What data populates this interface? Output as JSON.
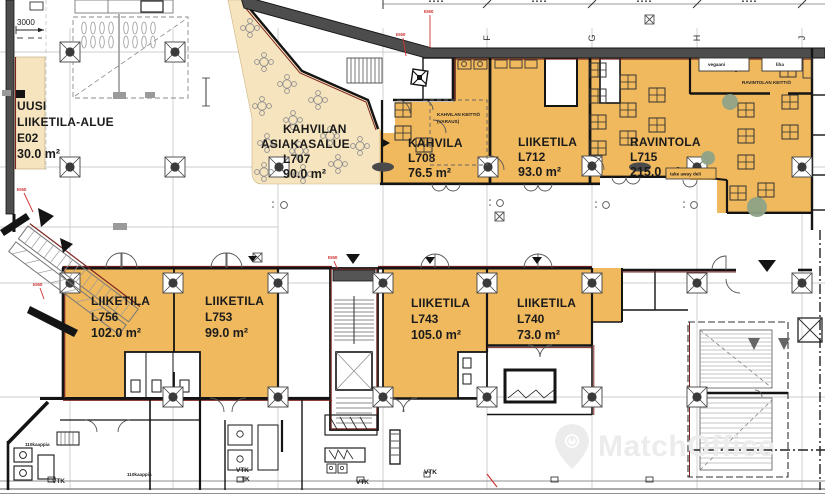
{
  "title": "Floor plan – commercial premises",
  "watermark": {
    "text": "MatchOffice"
  },
  "grid": {
    "letters": [
      "F",
      "G",
      "H",
      "J"
    ]
  },
  "dimensions": {
    "left_width": "3000"
  },
  "rooms": {
    "e02": {
      "l1": "UUSI",
      "l2": "LIIKETILA-ALUE",
      "id": "E02",
      "area": "30.0 m²"
    },
    "l707": {
      "l1": "KAHVILAN",
      "l2": "ASIAKASALUE",
      "id": "L707",
      "area": "90.0 m²"
    },
    "l708": {
      "name": "KAHVILA",
      "id": "L708",
      "area": "76.5 m²"
    },
    "l712": {
      "name": "LIIKETILA",
      "id": "L712",
      "area": "93.0 m²"
    },
    "l715": {
      "name": "RAVINTOLA",
      "id": "L715",
      "area": "215.0 m²"
    },
    "l756": {
      "name": "LIIKETILA",
      "id": "L756",
      "area": "102.0 m²"
    },
    "l753": {
      "name": "LIIKETILA",
      "id": "L753",
      "area": "99.0 m²"
    },
    "l743": {
      "name": "LIIKETILA",
      "id": "L743",
      "area": "105.0 m²"
    },
    "l740": {
      "name": "LIIKETILA",
      "id": "L740",
      "area": "73.0 m²"
    }
  },
  "annotations": {
    "cafe_kitchen_1": "KAHVILAN KEITTIÖ",
    "cafe_kitchen_2": "(VARAUS)",
    "restaurant_kitchen": "RAVINTOLAN KEITTIÖ",
    "vegan": "vegaani",
    "meat": "liha",
    "takeaway": "take away deli",
    "cabinets": "110kaappia",
    "vtk": "VTK",
    "tk": "TK",
    "fire_rating": "EI60"
  },
  "colors": {
    "room_orange": "#F0B95E",
    "terrace_tan": "#F6E4BE",
    "wall_black": "#141414",
    "facade_gray": "#4D4D4D",
    "fire_red": "#D02F2F",
    "boundary_maroon": "#7E2420",
    "grid_gray": "#BDBDBD",
    "plant_green": "#8FA388"
  }
}
